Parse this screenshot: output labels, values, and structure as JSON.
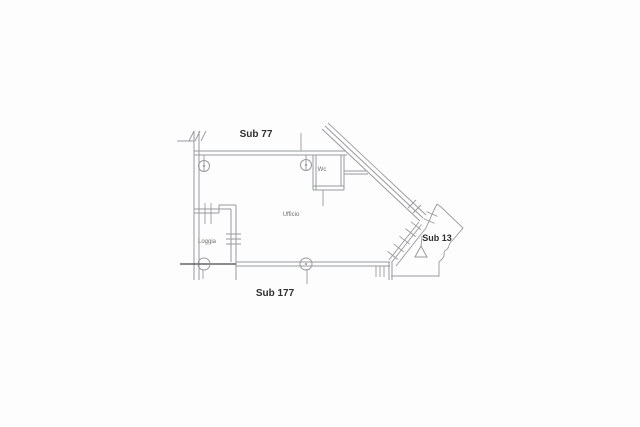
{
  "image": {
    "type": "cadastral-floor-plan",
    "background": "#fdfdfd"
  },
  "plan": {
    "unit_labels": {
      "top": "Sub 77",
      "bottom": "Sub 177",
      "right": "Sub 13"
    },
    "room_labels": {
      "office": "Ufficio",
      "toilet": "Wc",
      "balcony": "Loggia"
    },
    "symbols": {
      "column_markers": 4,
      "direction_triangle": 1,
      "door_hatch_marks": 5
    },
    "colors": {
      "line": "#98999b",
      "dark_line": "#474747",
      "label": "#2f2f2f",
      "room_label": "#6e6e6e"
    }
  }
}
